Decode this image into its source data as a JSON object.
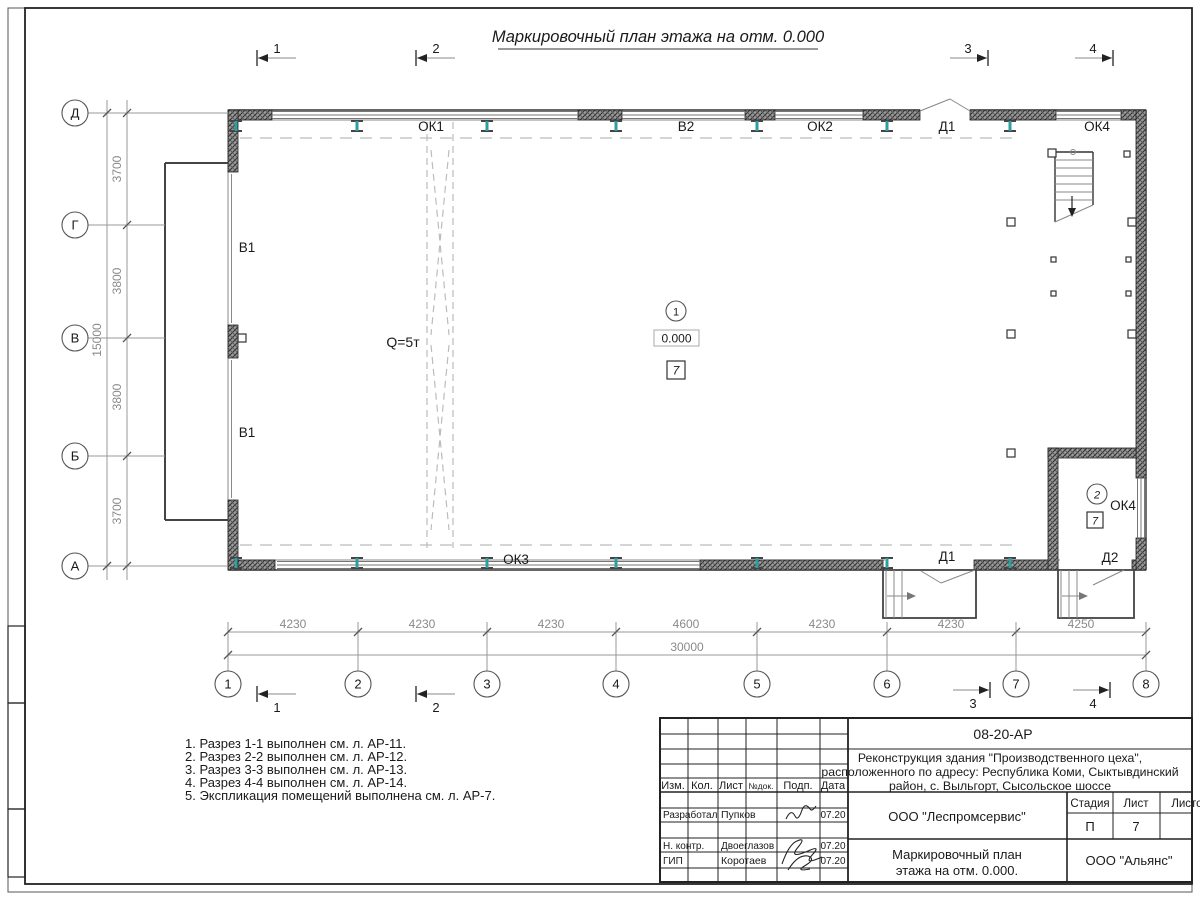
{
  "sheet_title": "Маркировочный план этажа на отм. 0.000",
  "axes": {
    "columns": [
      "1",
      "2",
      "3",
      "4",
      "5",
      "6",
      "7",
      "8"
    ],
    "rows": [
      "Д",
      "Г",
      "В",
      "Б",
      "А"
    ]
  },
  "sections": [
    "1",
    "2",
    "3",
    "4"
  ],
  "dims": {
    "bottom": [
      "4230",
      "4230",
      "4230",
      "4600",
      "4230",
      "4230",
      "4250"
    ],
    "bottom_total": "30000",
    "left": [
      "3700",
      "3800",
      "3800",
      "3700"
    ],
    "left_total": "15000"
  },
  "labels": {
    "ok1": "ОК1",
    "v2": "В2",
    "ok2": "ОК2",
    "d1_top": "Д1",
    "ok4_top": "ОК4",
    "v1_upper": "В1",
    "v1_lower": "В1",
    "crane": "Q=5т",
    "ok3": "ОК3",
    "d1_bottom": "Д1",
    "d2": "Д2",
    "room2_window": "ОК4"
  },
  "rooms": {
    "room1": {
      "number": "1",
      "elevation": "0.000",
      "floor_type": "7"
    },
    "room2": {
      "number": "2",
      "floor_type": "7"
    }
  },
  "notes": [
    "1. Разрез 1-1 выполнен см. л. АР-11.",
    "2. Разрез 2-2 выполнен см. л. АР-12.",
    "3. Разрез 3-3 выполнен см. л. АР-13.",
    "4. Разрез 4-4 выполнен см. л. АР-14.",
    "5. Экспликация помещений выполнена см. л. АР-7."
  ],
  "title_block": {
    "doc_number": "08-20-АР",
    "project_line1": "Реконструкция здания \"Производственного цеха\",",
    "project_line2": "расположенного по адресу: Республика Коми, Сыктывдинский",
    "project_line3": "район, с. Выльгорт, Сысольское шоссе",
    "headers": {
      "izm": "Изм.",
      "kol": "Кол.",
      "list": "Лист",
      "ndok": "№док.",
      "podp": "Подп.",
      "data": "Дата"
    },
    "rows": [
      {
        "role": "Разработал",
        "name": "Пупков",
        "date": "07.20"
      },
      {
        "role": "Н. контр.",
        "name": "Двоеглазов",
        "date": "07.20"
      },
      {
        "role": "ГИП",
        "name": "Коротаев",
        "date": "07.20"
      }
    ],
    "organization": "ООО \"Леспромсервис\"",
    "stage_label": "Стадия",
    "sheet_label": "Лист",
    "sheets_label": "Листов",
    "stage": "П",
    "sheet": "7",
    "drawing_name_line1": "Маркировочный план",
    "drawing_name_line2": "этажа на отм. 0.000.",
    "contractor": "ООО \"Альянс\""
  },
  "colors": {
    "beam_web": "#2e9e9e",
    "wall_fill": "#777777",
    "dim_text": "#8a8a8a",
    "line": "#333333"
  }
}
